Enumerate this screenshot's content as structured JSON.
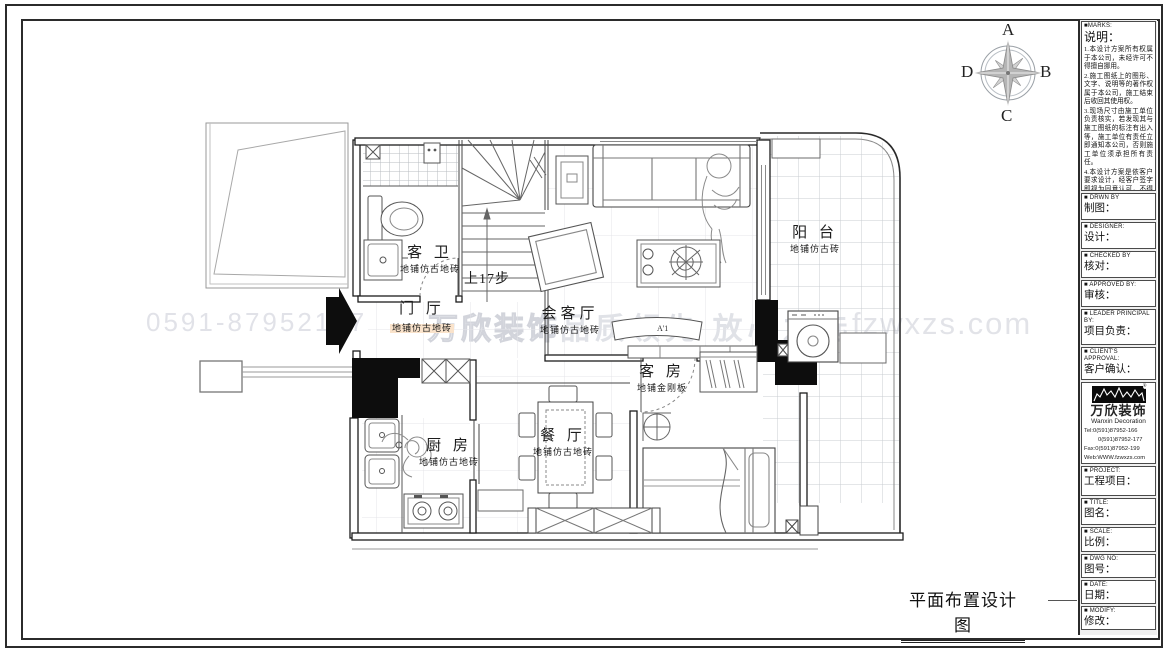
{
  "drawing_title": "平面布置设计图",
  "watermarks": {
    "phone": "0591-87952177",
    "brand": "万欣装饰",
    "slogan": "品质领先 放心之选",
    "site": "fzwxzs.com"
  },
  "compass": {
    "top": "A",
    "right": "B",
    "bottom": "C",
    "left": "D"
  },
  "plan": {
    "stair_note": "上17步",
    "marker": "A'1",
    "rooms": [
      {
        "id": "bathroom",
        "name": "客 卫",
        "floor": "地铺仿古地砖"
      },
      {
        "id": "foyer",
        "name": "门 厅",
        "floor": "地铺仿古地砖"
      },
      {
        "id": "living",
        "name": "会客厅",
        "floor": "地铺仿古地砖"
      },
      {
        "id": "balcony",
        "name": "阳 台",
        "floor": "地铺仿古砖"
      },
      {
        "id": "guest",
        "name": "客 房",
        "floor": "地铺金刚板"
      },
      {
        "id": "kitchen",
        "name": "厨 房",
        "floor": "地铺仿古地砖"
      },
      {
        "id": "dining",
        "name": "餐 厅",
        "floor": "地铺仿古地砖"
      }
    ]
  },
  "titleblock": {
    "marks": {
      "en": "■MARKS:",
      "zh": "说明：",
      "notes": [
        "1.本设计方案所有权属于本公司，未经许可不得擅自挪用。",
        "2.施工图纸上的图形、文字、说明等的著作权属于本公司，施工结束后收回其使用权。",
        "3.现场尺寸由施工单位负责核实，若发现其与施工图纸的标注有出入等，施工单位有责任立即通知本公司，否则施工单位须承担所有责任。",
        "4.本设计方案是依客户要求设计，经客户签字即视为同意认可，不得随意更改。"
      ]
    },
    "fields": [
      {
        "en": "■ DRWN BY",
        "zh": "制图："
      },
      {
        "en": "■ DESIGNER:",
        "zh": "设计："
      },
      {
        "en": "■ CHECKED BY",
        "zh": "核对："
      },
      {
        "en": "■ APPROVED BY:",
        "zh": "审核："
      },
      {
        "en": "■ LEADER PRINCIPAL BY:",
        "zh": "项目负责："
      },
      {
        "en": "■ CLIENT'S APPROVAL:",
        "zh": "客户确认："
      },
      {
        "en": "■ PROJECT:",
        "zh": "工程项目："
      },
      {
        "en": "■ TITLE:",
        "zh": "图名："
      },
      {
        "en": "■ SCALE:",
        "zh": "比例："
      },
      {
        "en": "■ DWG NO:",
        "zh": "图号："
      },
      {
        "en": "■ DATE:",
        "zh": "日期："
      },
      {
        "en": "■ MODIFY:",
        "zh": "修改："
      }
    ],
    "logo": {
      "brand": "万欣装饰",
      "brand_en": "Wanxin Decoration",
      "tel1": "Tel:0(591)87952-166",
      "tel2": "0(591)87952-177",
      "fax": "Fax:0(591)87952-199",
      "web": "Web:WWW.fzwxzs.com"
    }
  }
}
